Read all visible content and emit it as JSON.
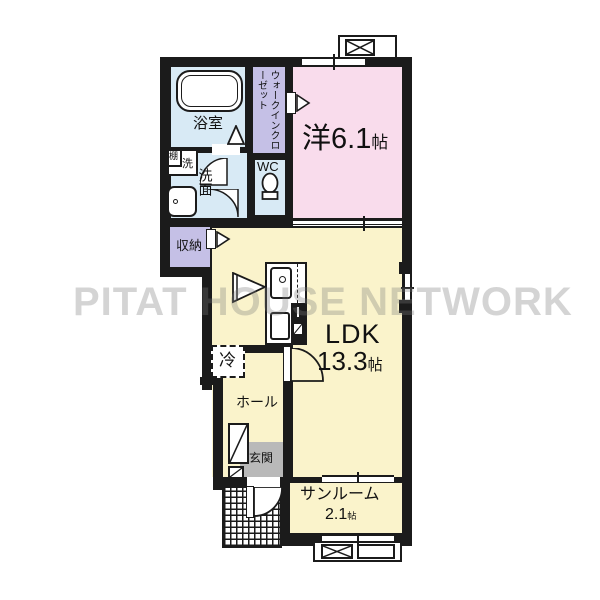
{
  "watermark": "PITAT HOUSE NETWORK",
  "rooms": {
    "bath": {
      "label": "浴室"
    },
    "walk_in_closet": {
      "label": "ウォークインクローゼット"
    },
    "western": {
      "prefix": "洋",
      "size": "6.1",
      "unit": "帖"
    },
    "washroom": {
      "label": "洗面"
    },
    "washer": {
      "shelf_label": "棚",
      "washer_label": "洗"
    },
    "wc": {
      "label": "WC"
    },
    "storage": {
      "label": "収納"
    },
    "ldk": {
      "label": "LDK",
      "size": "13.3",
      "unit": "帖"
    },
    "fridge": {
      "label": "冷"
    },
    "hall": {
      "label": "ホール"
    },
    "entrance": {
      "label": "玄関"
    },
    "sunroom": {
      "label": "サンルーム",
      "size": "2.1",
      "unit": "帖"
    }
  },
  "colors": {
    "wall": "#1b1b1b",
    "western_room": "#f9dcec",
    "ldk": "#faf3cb",
    "wet_area": "#d8eaf5",
    "closet": "#c5c0e6",
    "entrance": "#b9b9b9",
    "watermark": "#c9c9c9"
  }
}
